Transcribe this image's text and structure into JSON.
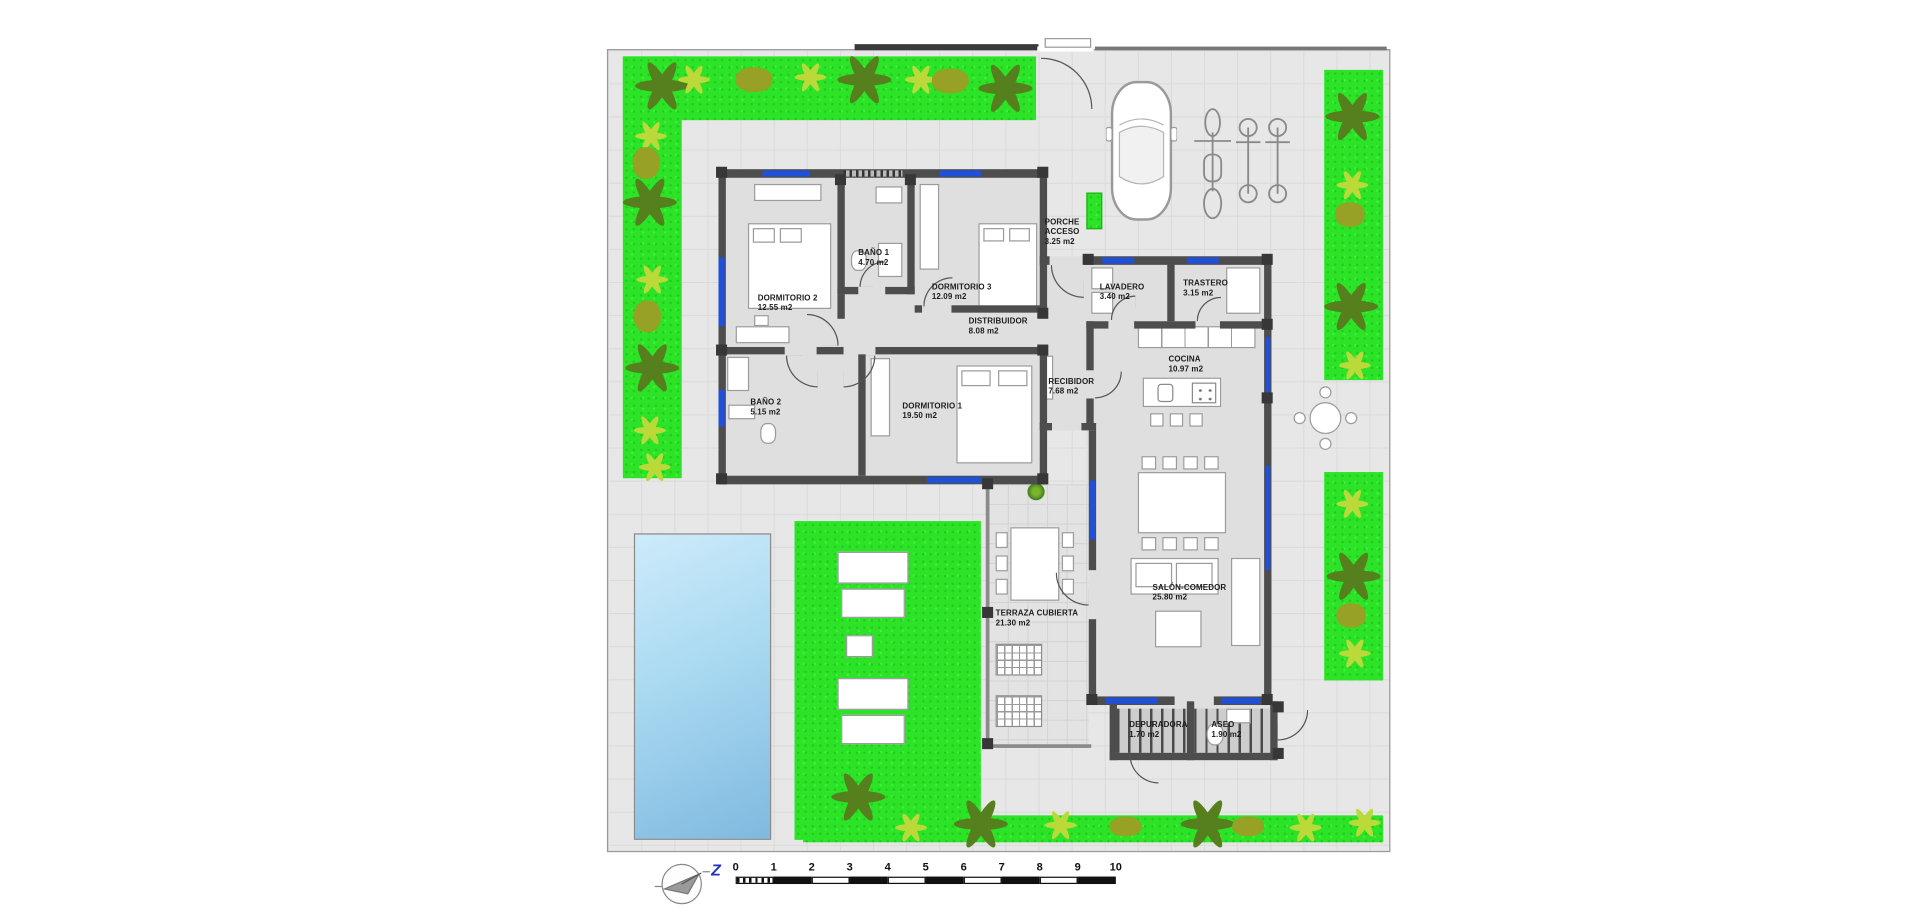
{
  "plan": {
    "rooms": [
      {
        "id": "dormitorio2",
        "label": "DORMITORIO 2",
        "area": "12.55 m2"
      },
      {
        "id": "bano1",
        "label": "BAÑO 1",
        "area": "4.70 m2"
      },
      {
        "id": "dormitorio3",
        "label": "DORMITORIO 3",
        "area": "12.09 m2"
      },
      {
        "id": "distribuidor",
        "label": "DISTRIBUIDOR",
        "area": "8.08 m2"
      },
      {
        "id": "porche-acceso",
        "label": "PORCHE ACCESO",
        "area": "3.25 m2"
      },
      {
        "id": "lavadero",
        "label": "LAVADERO",
        "area": "3.40 m2"
      },
      {
        "id": "trastero",
        "label": "TRASTERO",
        "area": "3.15 m2"
      },
      {
        "id": "recibidor",
        "label": "RECIBIDOR",
        "area": "7.68 m2"
      },
      {
        "id": "cocina",
        "label": "COCINA",
        "area": "10.97 m2"
      },
      {
        "id": "bano2",
        "label": "BAÑO 2",
        "area": "5.15 m2"
      },
      {
        "id": "dormitorio1",
        "label": "DORMITORIO 1",
        "area": "19.50 m2"
      },
      {
        "id": "salon-comedor",
        "label": "SALÓN-COMEDOR",
        "area": "25.80 m2"
      },
      {
        "id": "terraza-cubierta",
        "label": "TERRAZA CUBIERTA",
        "area": "21.30 m2"
      },
      {
        "id": "depuradora",
        "label": "DEPURADORA",
        "area": "1.70 m2"
      },
      {
        "id": "aseo",
        "label": "ASEO",
        "area": "1.90 m2"
      }
    ],
    "scale_bar": {
      "ticks": [
        "0",
        "1",
        "2",
        "3",
        "4",
        "5",
        "6",
        "7",
        "8",
        "9",
        "10"
      ]
    },
    "compass": {
      "letter": "Z"
    },
    "colors": {
      "grass": "#2ce327",
      "pool": "#a9d9f1",
      "wall": "#4d4d4d",
      "window": "#2050d8",
      "paving": "#e7e7e7"
    }
  }
}
